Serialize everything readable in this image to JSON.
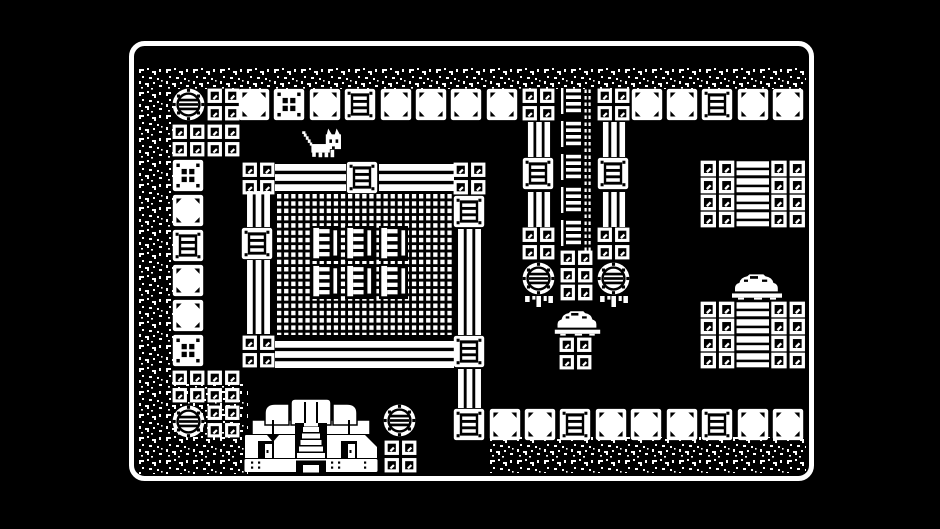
{
  "scene": {
    "title": "1-bit top-down adventure game screen",
    "background": "#000000",
    "ink": "#ffffff",
    "viewport": {
      "width": 940,
      "height": 529
    },
    "frame": {
      "x": 131.5,
      "y": 43.5,
      "width": 680,
      "height": 435,
      "radius": 13,
      "stroke_width": 5
    }
  },
  "legend": {
    "dirt": "dirt-speckles",
    "manhole": "manhole-tile",
    "sq4": "rivet-plate-tile",
    "sq2h": "rivet-plate-half-tile",
    "block": "stone-block-tile",
    "dots": "dotted-block-tile",
    "crate": "crate-block-tile",
    "vrail": "vertical-rail",
    "hrail": "horizontal-rail",
    "vtrack": "ladder-track",
    "mesh": "mesh-floor",
    "eshape": "shelf-rack",
    "mound": "rock-mound",
    "drip": "hanging-roots",
    "row": "fence-row",
    "house": "temple-building",
    "cat": "player-cat"
  },
  "defaults": {
    "manhole": [
      33,
      33
    ],
    "sq4": [
      33,
      33
    ],
    "sq2h": [
      33,
      17
    ],
    "block": [
      32,
      33
    ],
    "dots": [
      32,
      33
    ],
    "crate": [
      32,
      33
    ],
    "vrail": [
      26,
      36
    ],
    "hrail": [
      72,
      27
    ],
    "row": [
      106,
      17
    ],
    "eshape": [
      29,
      35
    ],
    "mound": [
      50,
      27
    ],
    "drip": [
      33,
      14
    ],
    "house": [
      134,
      76
    ],
    "cat": [
      44,
      31
    ],
    "vtrack": [
      36,
      164
    ]
  },
  "tiles": [
    {
      "t": "dirt",
      "x": 148,
      "y": 67,
      "w": 658,
      "h": 22
    },
    {
      "t": "dirt",
      "x": 137,
      "y": 67,
      "w": 36,
      "h": 343
    },
    {
      "t": "dirt",
      "x": 136,
      "y": 384,
      "w": 112,
      "h": 90
    },
    {
      "t": "dirt",
      "x": 487,
      "y": 437,
      "w": 319,
      "h": 36
    },
    {
      "t": "manhole",
      "x": 172,
      "y": 88
    },
    {
      "t": "sq4",
      "x": 207,
      "y": 88
    },
    {
      "t": "block",
      "x": 238,
      "y": 88
    },
    {
      "t": "dots",
      "x": 273,
      "y": 88
    },
    {
      "t": "block",
      "x": 309,
      "y": 88
    },
    {
      "t": "crate",
      "x": 344,
      "y": 88
    },
    {
      "t": "block",
      "x": 380,
      "y": 88
    },
    {
      "t": "block",
      "x": 415,
      "y": 88
    },
    {
      "t": "block",
      "x": 450,
      "y": 88
    },
    {
      "t": "block",
      "x": 486,
      "y": 88
    },
    {
      "t": "sq4",
      "x": 522,
      "y": 88
    },
    {
      "t": "vtrack",
      "x": 558,
      "y": 88
    },
    {
      "t": "sq4",
      "x": 597,
      "y": 88
    },
    {
      "t": "block",
      "x": 631,
      "y": 88
    },
    {
      "t": "block",
      "x": 666,
      "y": 88
    },
    {
      "t": "crate",
      "x": 701,
      "y": 88
    },
    {
      "t": "block",
      "x": 737,
      "y": 88
    },
    {
      "t": "block",
      "x": 772,
      "y": 88
    },
    {
      "t": "sq4",
      "x": 172,
      "y": 124
    },
    {
      "t": "sq4",
      "x": 207,
      "y": 124
    },
    {
      "t": "dots",
      "x": 172,
      "y": 159
    },
    {
      "t": "block",
      "x": 172,
      "y": 194
    },
    {
      "t": "crate",
      "x": 172,
      "y": 229
    },
    {
      "t": "block",
      "x": 172,
      "y": 264
    },
    {
      "t": "block",
      "x": 172,
      "y": 299
    },
    {
      "t": "dots",
      "x": 172,
      "y": 334
    },
    {
      "t": "sq4",
      "x": 172,
      "y": 370
    },
    {
      "t": "sq4",
      "x": 207,
      "y": 370
    },
    {
      "t": "manhole",
      "x": 172,
      "y": 405
    },
    {
      "t": "sq4",
      "x": 207,
      "y": 405
    },
    {
      "t": "sq4",
      "x": 242,
      "y": 162
    },
    {
      "t": "hrail",
      "x": 275,
      "y": 164,
      "w": 71,
      "h": 27
    },
    {
      "t": "crate",
      "x": 346,
      "y": 161
    },
    {
      "t": "hrail",
      "x": 379,
      "y": 164,
      "w": 75,
      "h": 27
    },
    {
      "t": "vrail",
      "x": 245,
      "y": 191,
      "w": 27,
      "h": 36
    },
    {
      "t": "crate",
      "x": 241,
      "y": 227
    },
    {
      "t": "vrail",
      "x": 245,
      "y": 260,
      "w": 27,
      "h": 74
    },
    {
      "t": "sq4",
      "x": 242,
      "y": 335
    },
    {
      "t": "hrail",
      "x": 275,
      "y": 341,
      "w": 179,
      "h": 27
    },
    {
      "t": "sq4",
      "x": 453,
      "y": 162
    },
    {
      "t": "crate",
      "x": 453,
      "y": 195
    },
    {
      "t": "vrail",
      "x": 456,
      "y": 229,
      "w": 27,
      "h": 106
    },
    {
      "t": "crate",
      "x": 453,
      "y": 335
    },
    {
      "t": "vrail",
      "x": 456,
      "y": 369,
      "w": 27,
      "h": 39
    },
    {
      "t": "mesh",
      "x": 277,
      "y": 194,
      "w": 175,
      "h": 141
    },
    {
      "t": "eshape",
      "x": 311,
      "y": 226
    },
    {
      "t": "eshape",
      "x": 345,
      "y": 226
    },
    {
      "t": "eshape",
      "x": 379,
      "y": 226
    },
    {
      "t": "eshape",
      "x": 311,
      "y": 264
    },
    {
      "t": "eshape",
      "x": 345,
      "y": 264
    },
    {
      "t": "eshape",
      "x": 379,
      "y": 264
    },
    {
      "t": "cat",
      "x": 301,
      "y": 127
    },
    {
      "t": "vrail",
      "x": 526,
      "y": 122,
      "w": 26,
      "h": 35
    },
    {
      "t": "crate",
      "x": 522,
      "y": 157
    },
    {
      "t": "vrail",
      "x": 526,
      "y": 192,
      "w": 26,
      "h": 35
    },
    {
      "t": "sq4",
      "x": 522,
      "y": 227
    },
    {
      "t": "manhole",
      "x": 522,
      "y": 262
    },
    {
      "t": "drip",
      "x": 522,
      "y": 296
    },
    {
      "t": "vrail",
      "x": 601,
      "y": 122,
      "w": 26,
      "h": 35
    },
    {
      "t": "crate",
      "x": 597,
      "y": 157
    },
    {
      "t": "vrail",
      "x": 601,
      "y": 192,
      "w": 26,
      "h": 35
    },
    {
      "t": "sq4",
      "x": 597,
      "y": 227
    },
    {
      "t": "manhole",
      "x": 597,
      "y": 262
    },
    {
      "t": "drip",
      "x": 597,
      "y": 296
    },
    {
      "t": "sq4",
      "x": 560,
      "y": 250
    },
    {
      "t": "sq2h",
      "x": 560,
      "y": 284
    },
    {
      "t": "mound",
      "x": 553,
      "y": 310,
      "w": 49,
      "h": 26
    },
    {
      "t": "sq4",
      "x": 559,
      "y": 337
    },
    {
      "t": "row",
      "x": 700,
      "y": 160
    },
    {
      "t": "row",
      "x": 700,
      "y": 177
    },
    {
      "t": "row",
      "x": 700,
      "y": 194
    },
    {
      "t": "row",
      "x": 700,
      "y": 211
    },
    {
      "t": "mound",
      "x": 730,
      "y": 273,
      "w": 54,
      "h": 27
    },
    {
      "t": "row",
      "x": 700,
      "y": 301
    },
    {
      "t": "row",
      "x": 700,
      "y": 318
    },
    {
      "t": "row",
      "x": 700,
      "y": 335
    },
    {
      "t": "row",
      "x": 700,
      "y": 352
    },
    {
      "t": "crate",
      "x": 453,
      "y": 408
    },
    {
      "t": "block",
      "x": 489,
      "y": 408
    },
    {
      "t": "block",
      "x": 524,
      "y": 408
    },
    {
      "t": "crate",
      "x": 559,
      "y": 408
    },
    {
      "t": "block",
      "x": 595,
      "y": 408
    },
    {
      "t": "block",
      "x": 630,
      "y": 408
    },
    {
      "t": "block",
      "x": 666,
      "y": 408
    },
    {
      "t": "crate",
      "x": 701,
      "y": 408
    },
    {
      "t": "block",
      "x": 737,
      "y": 408
    },
    {
      "t": "block",
      "x": 772,
      "y": 408
    },
    {
      "t": "house",
      "x": 244,
      "y": 397
    },
    {
      "t": "manhole",
      "x": 383,
      "y": 404
    },
    {
      "t": "sq4",
      "x": 384,
      "y": 440
    }
  ]
}
